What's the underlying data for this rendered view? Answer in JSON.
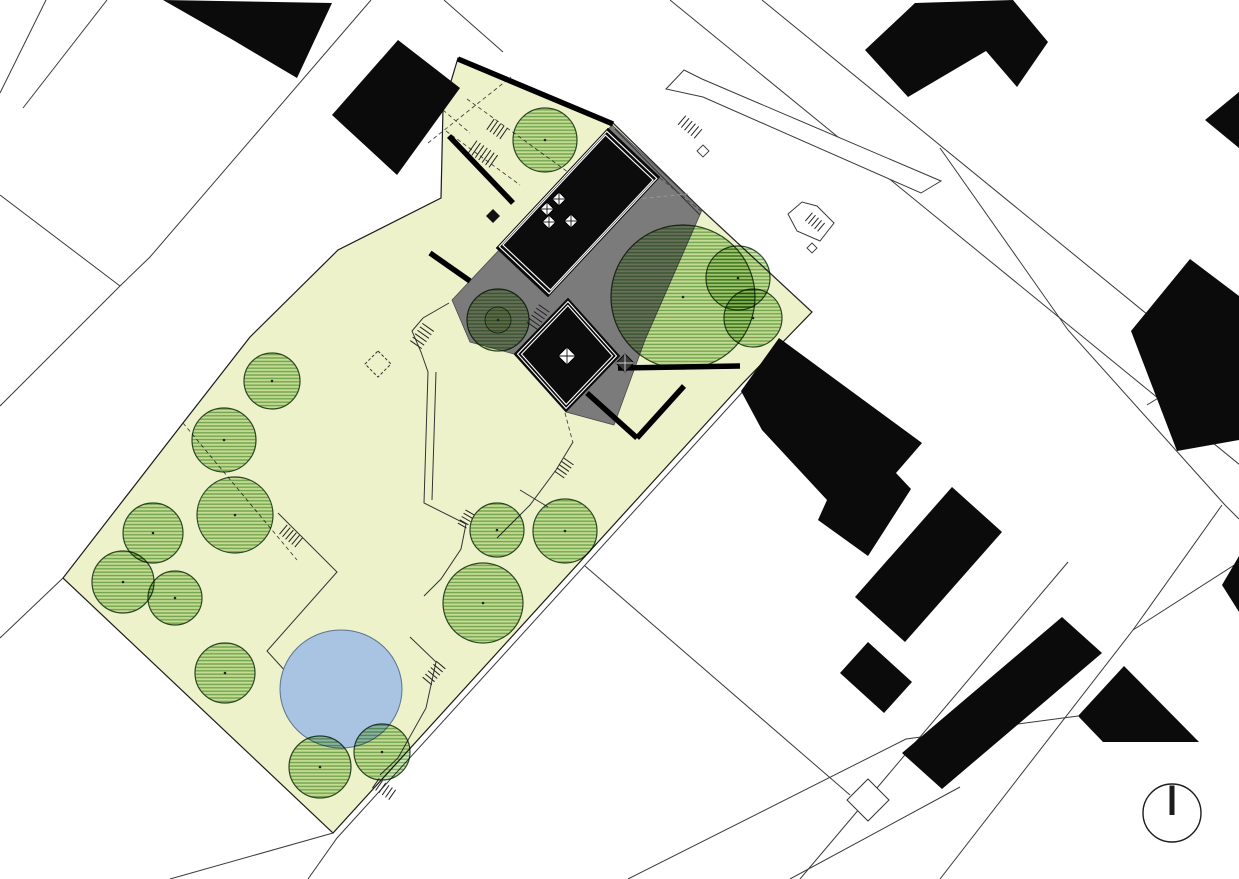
{
  "meta": {
    "drawing": "architectural-site-plan",
    "north_arrow_symbol": "circle-with-bar"
  },
  "canvas": {
    "width": 1239,
    "height": 879,
    "background": "#ffffff"
  },
  "colors": {
    "paper": "#ffffff",
    "site_fill": "#eef2cb",
    "site_stroke": "#1a1a1a",
    "terrace_gray": "#7b7b7b",
    "terrace_stroke": "#4a4a4a",
    "roof_black": "#0c0c0c",
    "roof_inset_line": "#ffffff",
    "building_black": "#0b0b0b",
    "pond_fill": "#a9c4e3",
    "pond_stroke": "#5a7391",
    "tree_stroke": "#2d4a2b",
    "tree_stripe": "#74ad5c",
    "tree_stripe_bg": "#d6e7bd",
    "tree_inner": "#e9efd2",
    "parcel_line": "#3a3a3a",
    "dash_line": "#444444",
    "dash_line_light": "#999999",
    "wall_black": "#000000",
    "north_arrow": "#1c1c1c"
  },
  "plan": {
    "site_outline": [
      [
        458,
        58
      ],
      [
        612,
        122
      ],
      [
        702,
        210
      ],
      [
        812,
        312
      ],
      [
        742,
        384
      ],
      [
        333,
        833
      ],
      [
        63,
        578
      ],
      [
        183,
        423
      ],
      [
        250,
        337
      ],
      [
        338,
        250
      ],
      [
        441,
        198
      ],
      [
        443,
        108
      ]
    ],
    "terrace": [
      [
        452,
        300
      ],
      [
        500,
        249
      ],
      [
        612,
        125
      ],
      [
        702,
        210
      ],
      [
        645,
        340
      ],
      [
        614,
        425
      ],
      [
        566,
        412
      ],
      [
        514,
        354
      ],
      [
        470,
        342
      ]
    ],
    "roofs": [
      {
        "name": "main-roof",
        "pts": [
          [
            608,
            128
          ],
          [
            660,
            177
          ],
          [
            548,
            297
          ],
          [
            496,
            248
          ]
        ]
      },
      {
        "name": "secondary-roof",
        "pts": [
          [
            568,
            298
          ],
          [
            620,
            356
          ],
          [
            566,
            412
          ],
          [
            514,
            354
          ]
        ]
      }
    ],
    "walls": [
      {
        "pts": [
          [
            458,
            59
          ],
          [
            613,
            124
          ]
        ]
      },
      {
        "pts": [
          [
            449,
            136
          ],
          [
            513,
            203
          ]
        ]
      },
      {
        "pts": [
          [
            430,
            253
          ],
          [
            470,
            281
          ]
        ]
      },
      {
        "pts": [
          [
            618,
            368
          ],
          [
            740,
            366
          ]
        ]
      },
      {
        "pts": [
          [
            587,
            393
          ],
          [
            637,
            438
          ]
        ]
      },
      {
        "pts": [
          [
            637,
            438
          ],
          [
            684,
            386
          ]
        ]
      }
    ],
    "skylights_main": [
      [
        547,
        209
      ],
      [
        559,
        199
      ],
      [
        549,
        222
      ],
      [
        571,
        221
      ]
    ],
    "skylight_secondary": [
      [
        567,
        356
      ]
    ],
    "skylight_size": 7,
    "skylight_secondary_size": 9,
    "dark_box": {
      "x": 625,
      "y": 363,
      "s": 9
    },
    "black_diamond": {
      "x": 493,
      "y": 216,
      "s": 7
    },
    "dashed_diamond": {
      "x": 378,
      "y": 364,
      "s": 13
    },
    "outline_diamond": {
      "x": 868,
      "y": 800,
      "s": 21
    },
    "pond": {
      "cx": 341,
      "cy": 689,
      "rx": 61,
      "ry": 59
    },
    "trees": [
      {
        "x": 545,
        "y": 140,
        "r": 32
      },
      {
        "x": 498,
        "y": 320,
        "r": 31,
        "inner": 13
      },
      {
        "x": 683,
        "y": 297,
        "r": 72
      },
      {
        "x": 738,
        "y": 278,
        "r": 32
      },
      {
        "x": 753,
        "y": 318,
        "r": 29
      },
      {
        "x": 272,
        "y": 381,
        "r": 28
      },
      {
        "x": 224,
        "y": 440,
        "r": 32
      },
      {
        "x": 235,
        "y": 515,
        "r": 38
      },
      {
        "x": 153,
        "y": 533,
        "r": 30
      },
      {
        "x": 123,
        "y": 582,
        "r": 31
      },
      {
        "x": 175,
        "y": 598,
        "r": 27
      },
      {
        "x": 225,
        "y": 673,
        "r": 30
      },
      {
        "x": 497,
        "y": 530,
        "r": 27
      },
      {
        "x": 565,
        "y": 531,
        "r": 32
      },
      {
        "x": 483,
        "y": 603,
        "r": 40
      },
      {
        "x": 320,
        "y": 767,
        "r": 31
      },
      {
        "x": 382,
        "y": 752,
        "r": 28
      }
    ],
    "neighbor_buildings": [
      {
        "name": "building-top-center",
        "pts": [
          [
            163,
            0
          ],
          [
            332,
            3
          ],
          [
            297,
            78
          ],
          [
            233,
            40
          ]
        ]
      },
      {
        "name": "building-top-left-of-site",
        "pts": [
          [
            332,
            115
          ],
          [
            398,
            40
          ],
          [
            460,
            88
          ],
          [
            397,
            175
          ]
        ]
      },
      {
        "name": "building-top-right",
        "pts": [
          [
            865,
            50
          ],
          [
            915,
            3
          ],
          [
            1013,
            0
          ],
          [
            1048,
            42
          ],
          [
            1017,
            87
          ],
          [
            986,
            51
          ],
          [
            908,
            97
          ]
        ]
      },
      {
        "name": "building-east-large",
        "pts": [
          [
            779,
            338
          ],
          [
            922,
            443
          ],
          [
            896,
            473
          ],
          [
            911,
            489
          ],
          [
            868,
            556
          ],
          [
            818,
            520
          ],
          [
            827,
            500
          ],
          [
            762,
            430
          ],
          [
            741,
            391
          ]
        ]
      },
      {
        "name": "building-east-bar",
        "pts": [
          [
            952,
            487
          ],
          [
            1002,
            532
          ],
          [
            905,
            642
          ],
          [
            855,
            597
          ]
        ]
      },
      {
        "name": "building-east-bar-foot",
        "pts": [
          [
            868,
            642
          ],
          [
            912,
            682
          ],
          [
            884,
            713
          ],
          [
            840,
            673
          ]
        ]
      },
      {
        "name": "building-southeast-bar",
        "pts": [
          [
            902,
            753
          ],
          [
            1062,
            617
          ],
          [
            1102,
            653
          ],
          [
            942,
            789
          ]
        ]
      },
      {
        "name": "building-bottom-right",
        "pts": [
          [
            1078,
            716
          ],
          [
            1124,
            666
          ],
          [
            1199,
            742
          ],
          [
            1103,
            742
          ]
        ]
      },
      {
        "name": "building-right-slab",
        "pts": [
          [
            1131,
            331
          ],
          [
            1190,
            259
          ],
          [
            1239,
            296
          ],
          [
            1239,
            440
          ],
          [
            1177,
            451
          ]
        ]
      },
      {
        "name": "building-right-edge-wedge-top",
        "pts": [
          [
            1205,
            120
          ],
          [
            1239,
            92
          ],
          [
            1239,
            148
          ]
        ]
      },
      {
        "name": "building-right-edge-wedge",
        "pts": [
          [
            1222,
            585
          ],
          [
            1239,
            556
          ],
          [
            1239,
            612
          ]
        ]
      }
    ],
    "parcel_lines": [
      {
        "pts": [
          [
            46,
            0
          ],
          [
            0,
            93
          ]
        ]
      },
      {
        "pts": [
          [
            107,
            0
          ],
          [
            23,
            108
          ]
        ]
      },
      {
        "pts": [
          [
            371,
            0
          ],
          [
            150,
            257
          ],
          [
            120,
            286
          ]
        ]
      },
      {
        "pts": [
          [
            0,
            195
          ],
          [
            120,
            286
          ]
        ]
      },
      {
        "pts": [
          [
            120,
            286
          ],
          [
            60,
            346
          ],
          [
            0,
            406
          ]
        ]
      },
      {
        "pts": [
          [
            63,
            578
          ],
          [
            0,
            638
          ]
        ]
      },
      {
        "pts": [
          [
            444,
            0
          ],
          [
            503,
            52
          ]
        ]
      },
      {
        "pts": [
          [
            670,
            0
          ],
          [
            1240,
            465
          ]
        ]
      },
      {
        "pts": [
          [
            762,
            0
          ],
          [
            1240,
            390
          ]
        ]
      },
      {
        "pts": [
          [
            940,
            148
          ],
          [
            1068,
            330
          ],
          [
            1225,
            505
          ],
          [
            1239,
            519
          ]
        ]
      },
      {
        "pts": [
          [
            1147,
            405
          ],
          [
            1239,
            348
          ]
        ]
      },
      {
        "pts": [
          [
            1222,
            505
          ],
          [
            1133,
            630
          ],
          [
            940,
            879
          ]
        ]
      },
      {
        "pts": [
          [
            1133,
            630
          ],
          [
            1239,
            562
          ]
        ]
      },
      {
        "pts": [
          [
            1068,
            562
          ],
          [
            800,
            879
          ]
        ]
      },
      {
        "pts": [
          [
            628,
            879
          ],
          [
            906,
            739
          ],
          [
            1078,
            716
          ]
        ]
      },
      {
        "pts": [
          [
            746,
            388
          ],
          [
            337,
            838
          ],
          [
            308,
            879
          ]
        ]
      },
      {
        "pts": [
          [
            333,
            833
          ],
          [
            170,
            879
          ]
        ]
      },
      {
        "pts": [
          [
            585,
            566
          ],
          [
            850,
            795
          ]
        ]
      },
      {
        "pts": [
          [
            790,
            879
          ],
          [
            960,
            787
          ]
        ]
      }
    ],
    "overlay_lines": [
      {
        "pts": [
          [
            612,
            122
          ],
          [
            702,
            210
          ],
          [
            812,
            312
          ]
        ]
      },
      {
        "pts": [
          [
            615,
            129
          ],
          [
            700,
            215
          ]
        ]
      }
    ],
    "paths": [
      {
        "pts": [
          [
            449,
            303
          ],
          [
            423,
            318
          ],
          [
            412,
            331
          ],
          [
            421,
            352
          ],
          [
            428,
            372
          ],
          [
            424,
            503
          ],
          [
            466,
            524
          ],
          [
            461,
            549
          ],
          [
            441,
            579
          ],
          [
            424,
            596
          ]
        ]
      },
      {
        "pts": [
          [
            436,
            372
          ],
          [
            432,
            500
          ]
        ]
      },
      {
        "pts": [
          [
            410,
            637
          ],
          [
            436,
            662
          ],
          [
            426,
            708
          ],
          [
            398,
            758
          ],
          [
            380,
            775
          ]
        ]
      },
      {
        "pts": [
          [
            278,
            513
          ],
          [
            337,
            572
          ],
          [
            267,
            651
          ],
          [
            297,
            684
          ]
        ]
      },
      {
        "pts": [
          [
            573,
            442
          ],
          [
            556,
            470
          ],
          [
            530,
            505
          ],
          [
            497,
            538
          ]
        ]
      },
      {
        "pts": [
          [
            520,
            490
          ],
          [
            548,
            507
          ]
        ]
      }
    ],
    "dashed_lines": [
      {
        "pts": [
          [
            467,
            99
          ],
          [
            601,
            196
          ]
        ]
      },
      {
        "pts": [
          [
            446,
            131
          ],
          [
            520,
            185
          ]
        ]
      },
      {
        "pts": [
          [
            428,
            143
          ],
          [
            511,
            77
          ]
        ]
      },
      {
        "pts": [
          [
            660,
            178
          ],
          [
            701,
            211
          ]
        ]
      },
      {
        "pts": [
          [
            573,
            205
          ],
          [
            688,
            194
          ]
        ],
        "light": true
      },
      {
        "pts": [
          [
            183,
            423
          ],
          [
            297,
            560
          ]
        ]
      },
      {
        "pts": [
          [
            565,
            413
          ],
          [
            573,
            443
          ]
        ]
      },
      {
        "pts": [
          [
            443,
            110
          ],
          [
            470,
            133
          ]
        ]
      }
    ],
    "step_hatches": [
      {
        "cx": 483,
        "cy": 154,
        "travel": 35,
        "count": 7,
        "len": 15,
        "gap": 4.2
      },
      {
        "cx": 497,
        "cy": 129,
        "travel": 35,
        "count": 5,
        "len": 13,
        "gap": 4
      },
      {
        "cx": 538,
        "cy": 317,
        "travel": 125,
        "count": 6,
        "len": 13,
        "gap": 4.2
      },
      {
        "cx": 422,
        "cy": 336,
        "travel": 125,
        "count": 6,
        "len": 14,
        "gap": 4.2
      },
      {
        "cx": 466,
        "cy": 519,
        "travel": 120,
        "count": 5,
        "len": 10,
        "gap": 3.8
      },
      {
        "cx": 291,
        "cy": 536,
        "travel": 40,
        "count": 6,
        "len": 12,
        "gap": 4
      },
      {
        "cx": 434,
        "cy": 673,
        "travel": 130,
        "count": 6,
        "len": 12,
        "gap": 4.2
      },
      {
        "cx": 384,
        "cy": 789,
        "travel": 35,
        "count": 6,
        "len": 12,
        "gap": 4
      },
      {
        "cx": 690,
        "cy": 127,
        "travel": 40,
        "count": 6,
        "len": 12,
        "gap": 4.2
      },
      {
        "cx": 815,
        "cy": 222,
        "travel": 40,
        "count": 5,
        "len": 11,
        "gap": 4
      },
      {
        "cx": 564,
        "cy": 468,
        "travel": 125,
        "count": 5,
        "len": 12,
        "gap": 4
      }
    ],
    "road_features": [
      {
        "name": "road-curb-long",
        "pts": [
          [
            666,
            89
          ],
          [
            684,
            70
          ],
          [
            702,
            79
          ],
          [
            941,
            181
          ],
          [
            921,
            193
          ],
          [
            703,
            97
          ]
        ]
      },
      {
        "name": "road-curb-small",
        "pts": [
          [
            788,
            214
          ],
          [
            802,
            202
          ],
          [
            817,
            206
          ],
          [
            834,
            223
          ],
          [
            820,
            241
          ],
          [
            797,
            231
          ]
        ]
      }
    ],
    "tiny_boxes": [
      {
        "x": 703,
        "y": 151,
        "s": 6
      },
      {
        "x": 812,
        "y": 248,
        "s": 5
      }
    ],
    "north_arrow": {
      "cx": 1172,
      "cy": 813,
      "r": 29
    }
  }
}
